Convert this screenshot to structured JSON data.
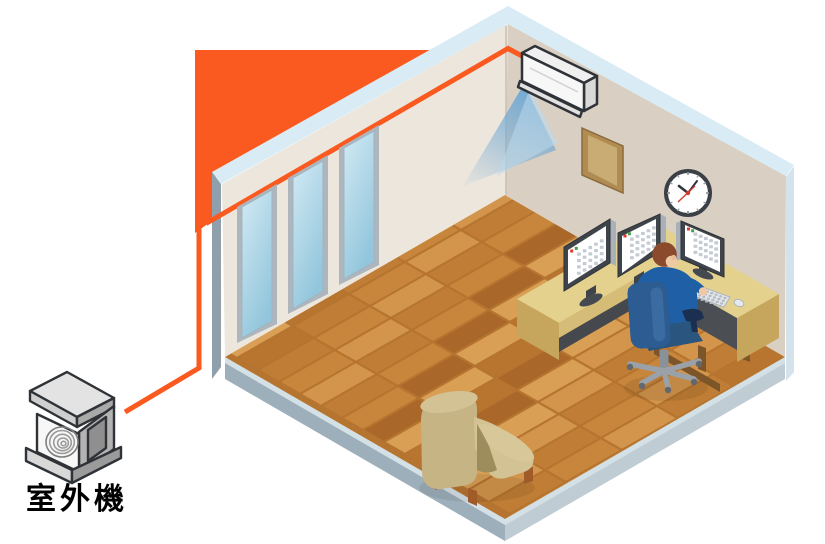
{
  "title": "Air conditioner room installation illustration",
  "label": {
    "outdoor_unit": "室外機"
  },
  "colors": {
    "outline": "#2F3337",
    "pipe": "#FA5A1F",
    "accent_wall": "#FA5A1F",
    "trim": "#D9ECF5",
    "wall_left": "#ECE6DD",
    "wall_right": "#D9D0C3",
    "edge_left": "#8FA0AC",
    "edge_right": "#D4E3EB",
    "corner_line": "#C9BFB2",
    "floor_base": "#B5742F",
    "plank_palette": [
      "#C8863C",
      "#B8752F",
      "#D2954B",
      "#AA672A",
      "#C07D35",
      "#D89F55"
    ],
    "slab_top": "#D3E0E6",
    "slab_left": "#9DAFBA",
    "slab_right": "#BFCCD4",
    "window_frame": "#AEB6BD",
    "glass_top": "#D2EAF4",
    "glass_bottom": "#93C6DC",
    "ac_front": "#F7F7F7",
    "ac_side": "#D9D9D9",
    "ac_top": "#EFEFEF",
    "air": "#6FA8D4",
    "board_outer": "#B18C52",
    "board_inner": "#C9AC73",
    "clock_rim": "#3A4046",
    "clock_face": "#FFFFFF",
    "clock_red": "#D23B2F",
    "clock_tick": "#99A0A7",
    "clock_hand": "#2F353B",
    "desk_top": "#E3D18D",
    "desk_front": "#D5BC77",
    "desk_end": "#C6A65C",
    "desk_dark": "#4B4F54",
    "desk_foot": "#7C5628",
    "monitor_frame": "#3F444B",
    "monitor_side": "#A9B0B8",
    "screen": "#FFFFFF",
    "screen_red": "#E0392E",
    "screen_green": "#3FA047",
    "screen_cell": "#C5CBD3",
    "keyboard": "#E3E6EA",
    "key": "#B3BAC2",
    "shirt": "#1E5FA5",
    "pants": "#1D2E4E",
    "skin": "#EFC9A3",
    "ear": "#E7BD93",
    "hair": "#8B4A2B",
    "chair": "#2C5C92",
    "chair_seat": "#2A557F",
    "chair_dark": "#1B3050",
    "chair_base": "#9AA1A8",
    "caster": "#62686E",
    "lift": "#8A9198",
    "armchair": "#C6B485",
    "armchair_light": "#D3C394",
    "armchair_roll": "#D8C899",
    "armchair_shadow": "#9D8C5C",
    "armchair_leg": "#A05C28",
    "unit_top": "#E3E3E3",
    "unit_front": "#F7F7F7",
    "unit_left": "#CFCFCF",
    "unit_right": "#A9A9A9",
    "unit_base_l": "#D8D8D8",
    "unit_base_r": "#9B9B9B",
    "fan_ring": "#9A9A9A",
    "label_text": "#000000"
  }
}
